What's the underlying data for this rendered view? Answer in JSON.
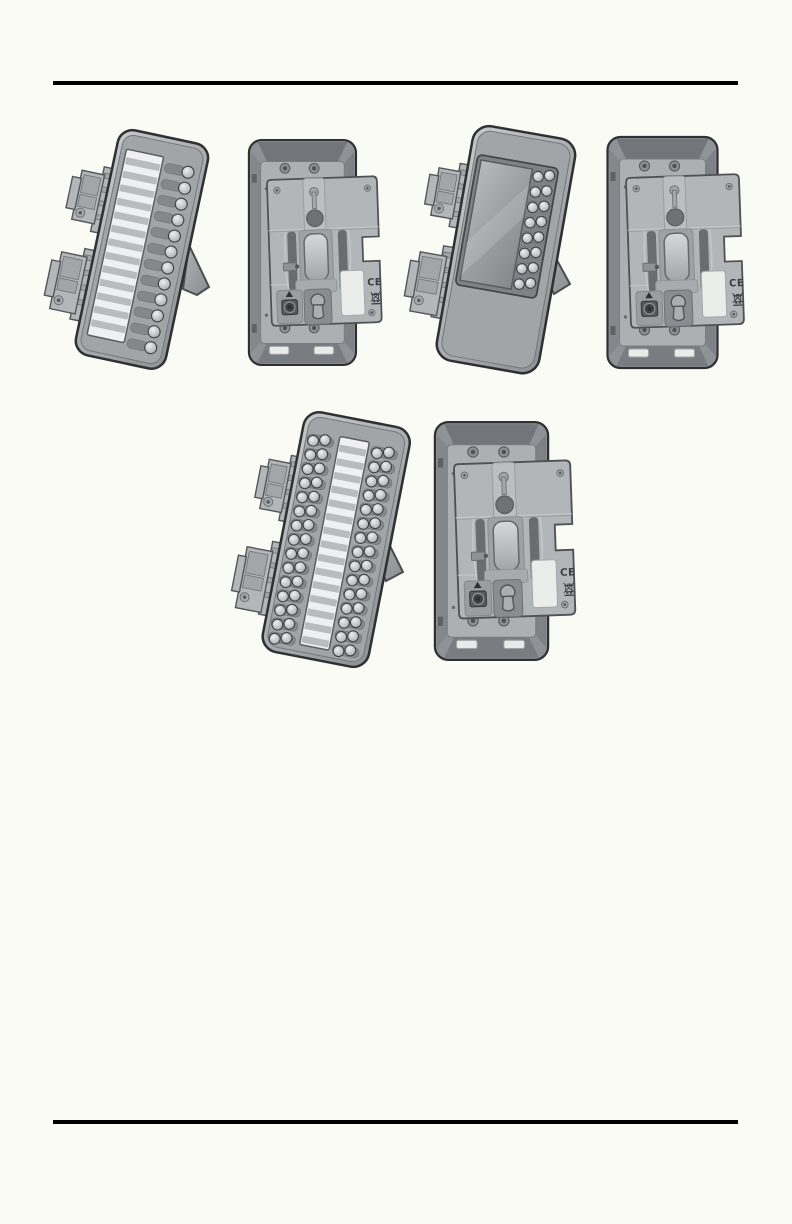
{
  "page": {
    "background": "#fbfbf6",
    "rule_color": "#000000"
  },
  "marks": {
    "ce": "CE"
  },
  "palette": {
    "outline": "#2e3032",
    "body_gray": "#9a9da1",
    "panel_gray": "#adb0b3",
    "card_white": "#eff0f1",
    "label_white": "#ebedeb",
    "dark_recess": "#6a6d70"
  },
  "figures": {
    "front_12key": {
      "name": "key-expansion-module-front",
      "keys": 12,
      "card_lines": 13
    },
    "back_a": {
      "name": "expansion-module-rear-wall-mount"
    },
    "lcd_front": {
      "name": "display-expansion-module-front",
      "key_rows": 8
    },
    "back_b": {
      "name": "display-expansion-module-rear-wall-mount"
    },
    "front_large": {
      "name": "dual-column-expansion-module-front",
      "key_rows": 15,
      "card_lines": 15
    },
    "back_c": {
      "name": "dual-column-expansion-module-rear-wall-mount"
    }
  }
}
